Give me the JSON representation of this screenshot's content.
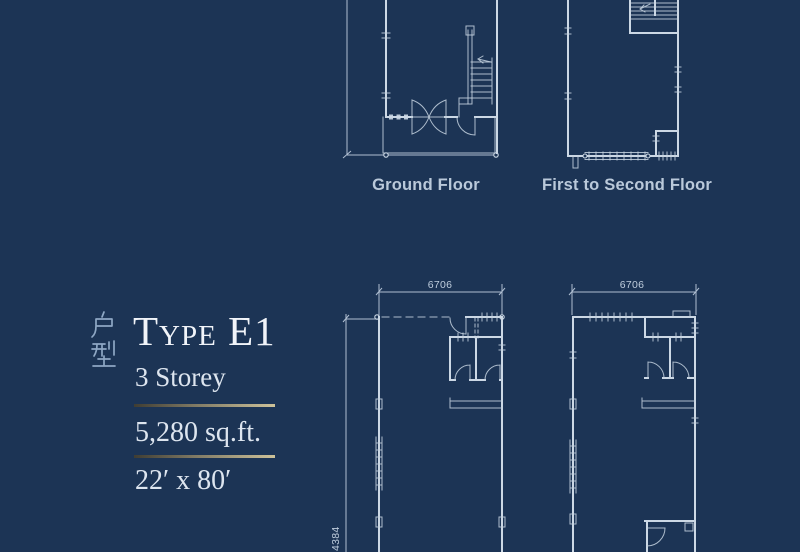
{
  "page": {
    "background": "#1c3455",
    "plan_line_color": "#ccd8e5",
    "label_color": "#bac9da",
    "gold_dark": "#3f3d33",
    "gold_light": "#cdc29a"
  },
  "unit": {
    "cjk_label": "户型",
    "title": "Type E1",
    "storey": "3 Storey",
    "area": "5,280 sq.ft.",
    "size": "22′ x 80′"
  },
  "floor_labels": {
    "ground": "Ground Floor",
    "upper": "First to Second Floor"
  },
  "dimensions": {
    "width": "6706",
    "depth": "4384"
  }
}
